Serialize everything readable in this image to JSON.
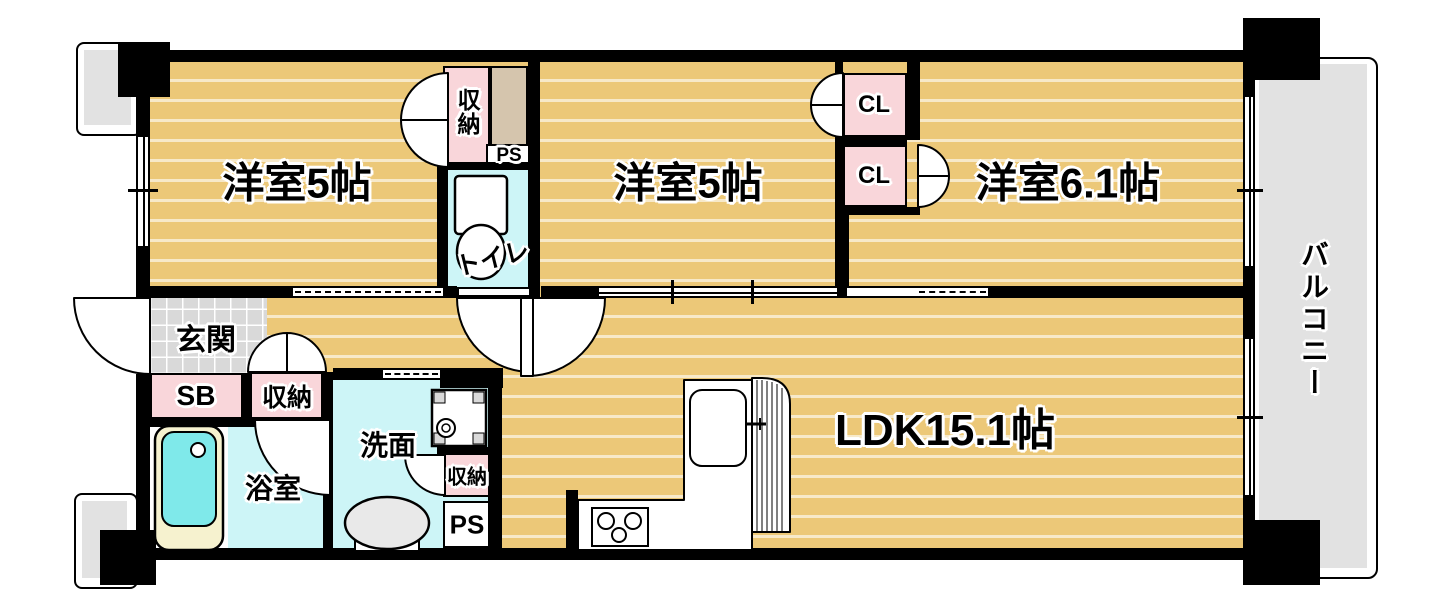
{
  "labels": {
    "room1": "洋室5帖",
    "room2": "洋室5帖",
    "room3": "洋室6.1帖",
    "ldk": "LDK15.1帖",
    "balcony": "バルコニー",
    "genkan": "玄関",
    "shoe_box": "SB",
    "hall_closet": "収納",
    "top_closet": "収納",
    "wash_closet": "収納",
    "ps_upper": "PS",
    "ps_lower": "PS",
    "toilet": "トイレ",
    "bath": "浴室",
    "wash": "洗面",
    "cl1": "CL",
    "cl2": "CL"
  },
  "fixtures": [
    "bathtub-icon",
    "toilet-icon",
    "washing-machine-pan-icon",
    "basin-icon",
    "kitchen-sink-icon",
    "stove-icon"
  ],
  "colors": {
    "wood": "#ecc878",
    "wet_floor": "#cdf5f7",
    "closet_pink": "#f9d6da",
    "tile_gray": "#d9d9d9",
    "exterior_gray": "#e2e2e2",
    "wall": "#000000",
    "tub": "#7fe9ea",
    "tub_rim": "#f6f2cf",
    "duct_tan": "#d5c5ad",
    "fixture_gray": "#e9e9e9"
  }
}
